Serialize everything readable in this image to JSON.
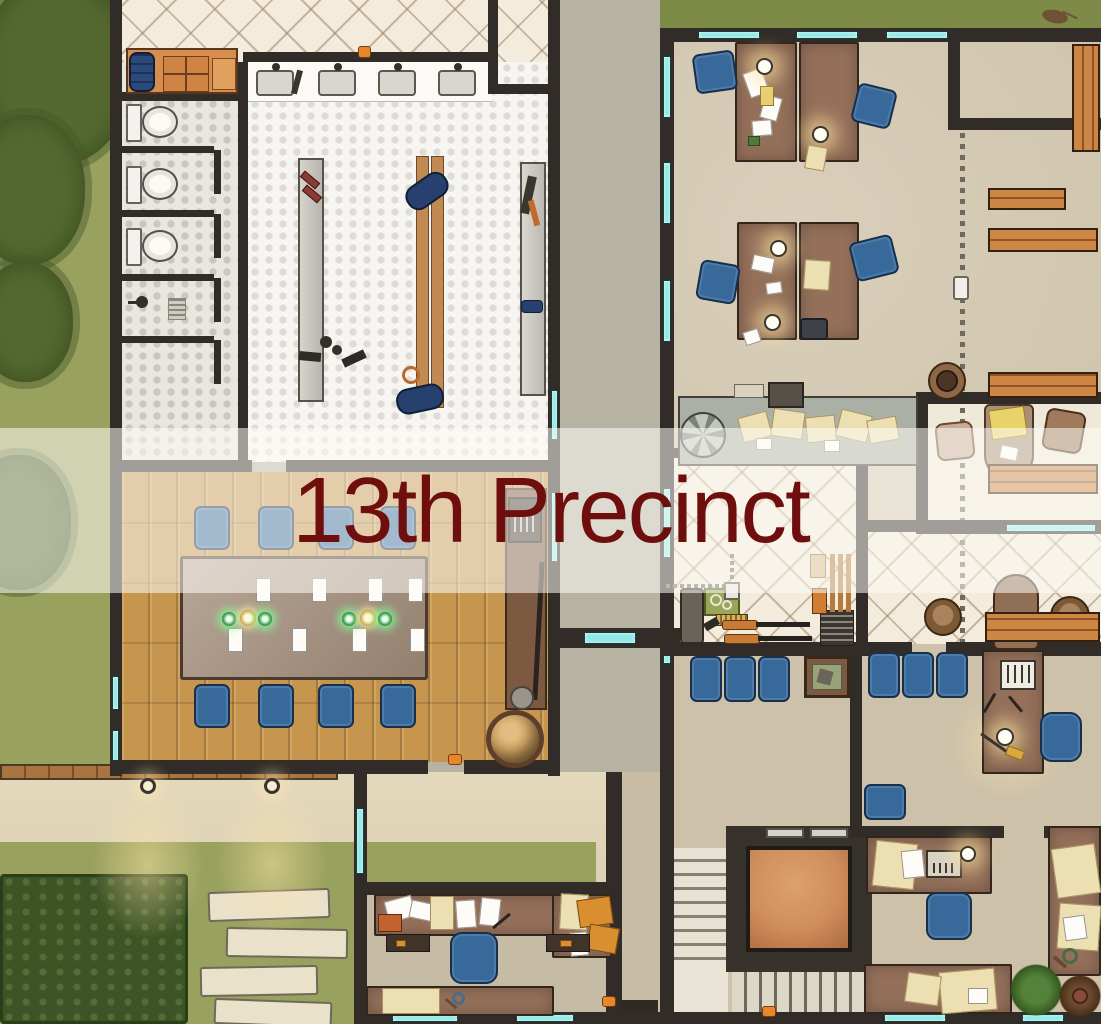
{
  "banner": {
    "title": "13th Precinct"
  },
  "colors": {
    "title": "#6e0f0e",
    "banner_bg": "rgba(253,251,246,0.55)",
    "wall": "#312c27",
    "window_glass": "#8fe9e6",
    "grass": "#99a15e",
    "grass_dark": "#7e8a48",
    "hedge": "#3e5426",
    "patio": "#dccfb4",
    "wood_floor": "#c6964f",
    "tile_cream": "#f3ebdb",
    "tile_white": "#f7f5f1",
    "floor_tan": "#cdc1aa",
    "chair_blue": "#37699b",
    "desk_brown": "#94705a",
    "bench_wood": "#cd8643",
    "elevator_floor": "#cf8d5d"
  }
}
